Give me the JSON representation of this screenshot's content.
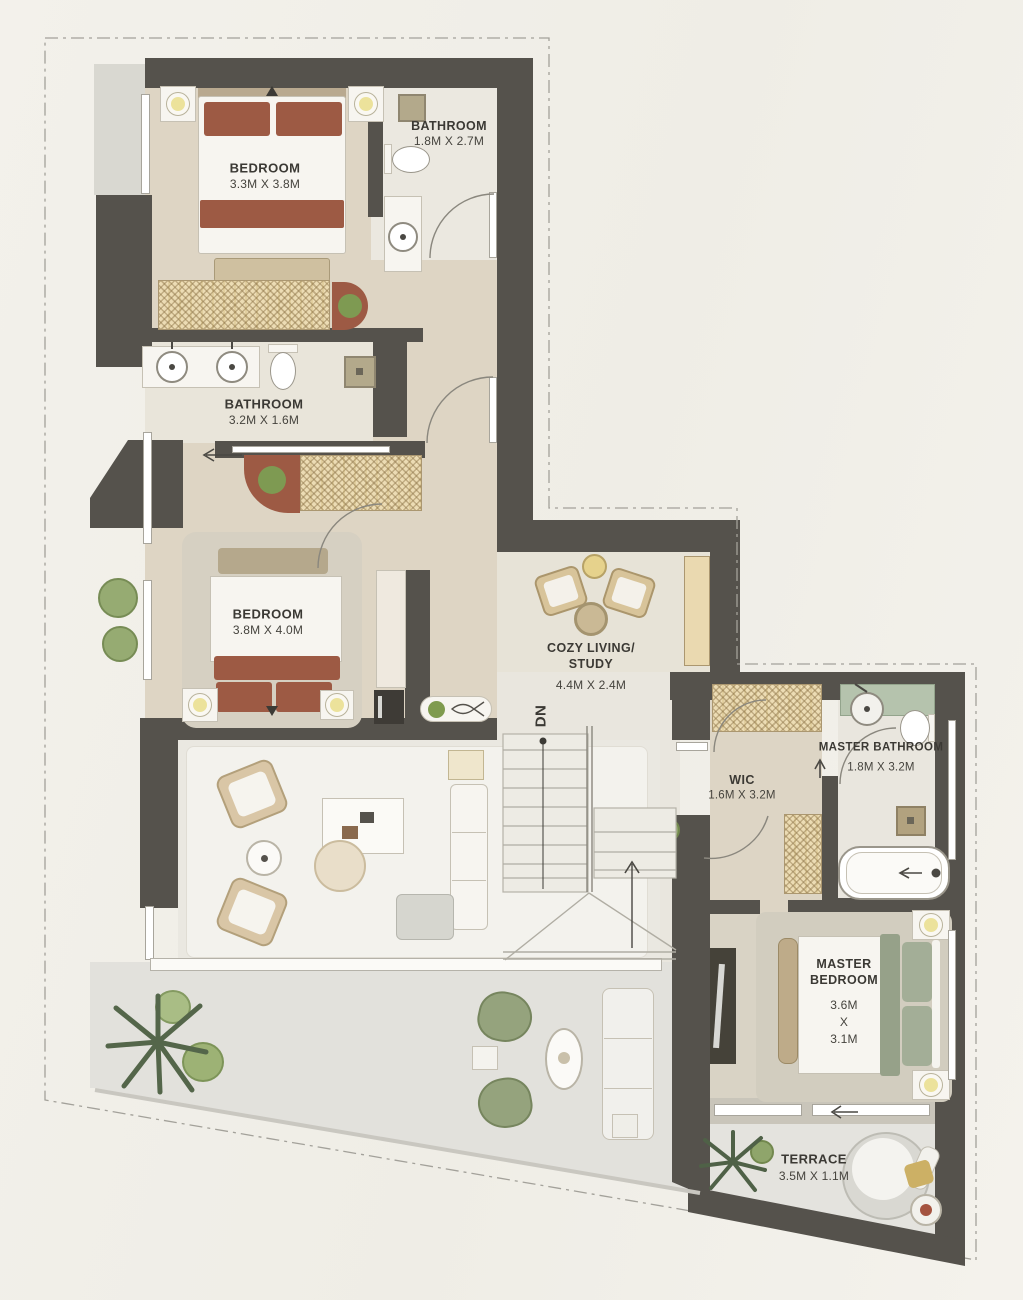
{
  "plan": {
    "rooms": {
      "bedroom1": {
        "name": "BEDROOM",
        "dims": "3.3M X 3.8M"
      },
      "bathroom1": {
        "name": "BATHROOM",
        "dims": "1.8M X 2.7M"
      },
      "bathroom2": {
        "name": "BATHROOM",
        "dims": "3.2M X 1.6M"
      },
      "bedroom2": {
        "name": "BEDROOM",
        "dims": "3.8M X 4.0M"
      },
      "cozy_living": {
        "name": "COZY LIVING/\nSTUDY",
        "dims": "4.4M X 2.4M"
      },
      "wic": {
        "name": "WIC",
        "dims": "1.6M X 3.2M"
      },
      "master_bathroom": {
        "name": "MASTER BATHROOM",
        "dims": "1.8M X 3.2M"
      },
      "master_bedroom": {
        "name": "MASTER\nBEDROOM",
        "dims": "3.6M\nX\n3.1M"
      },
      "terrace": {
        "name": "TERRACE",
        "dims": "3.5M X 1.1M"
      }
    },
    "stairs": {
      "down_label": "DN"
    },
    "colors": {
      "wall": "#55524c",
      "floor_beige": "#ded5c4",
      "floor_light": "#eae8e1",
      "accent_rust": "#9d5a44",
      "accent_sage": "#a3ae97",
      "wardrobe_tan": "#ecdcb4",
      "lamp_yellow": "#ece29b",
      "marble_green": "#b5c3ad",
      "plant_green": "#7e9a52"
    }
  }
}
